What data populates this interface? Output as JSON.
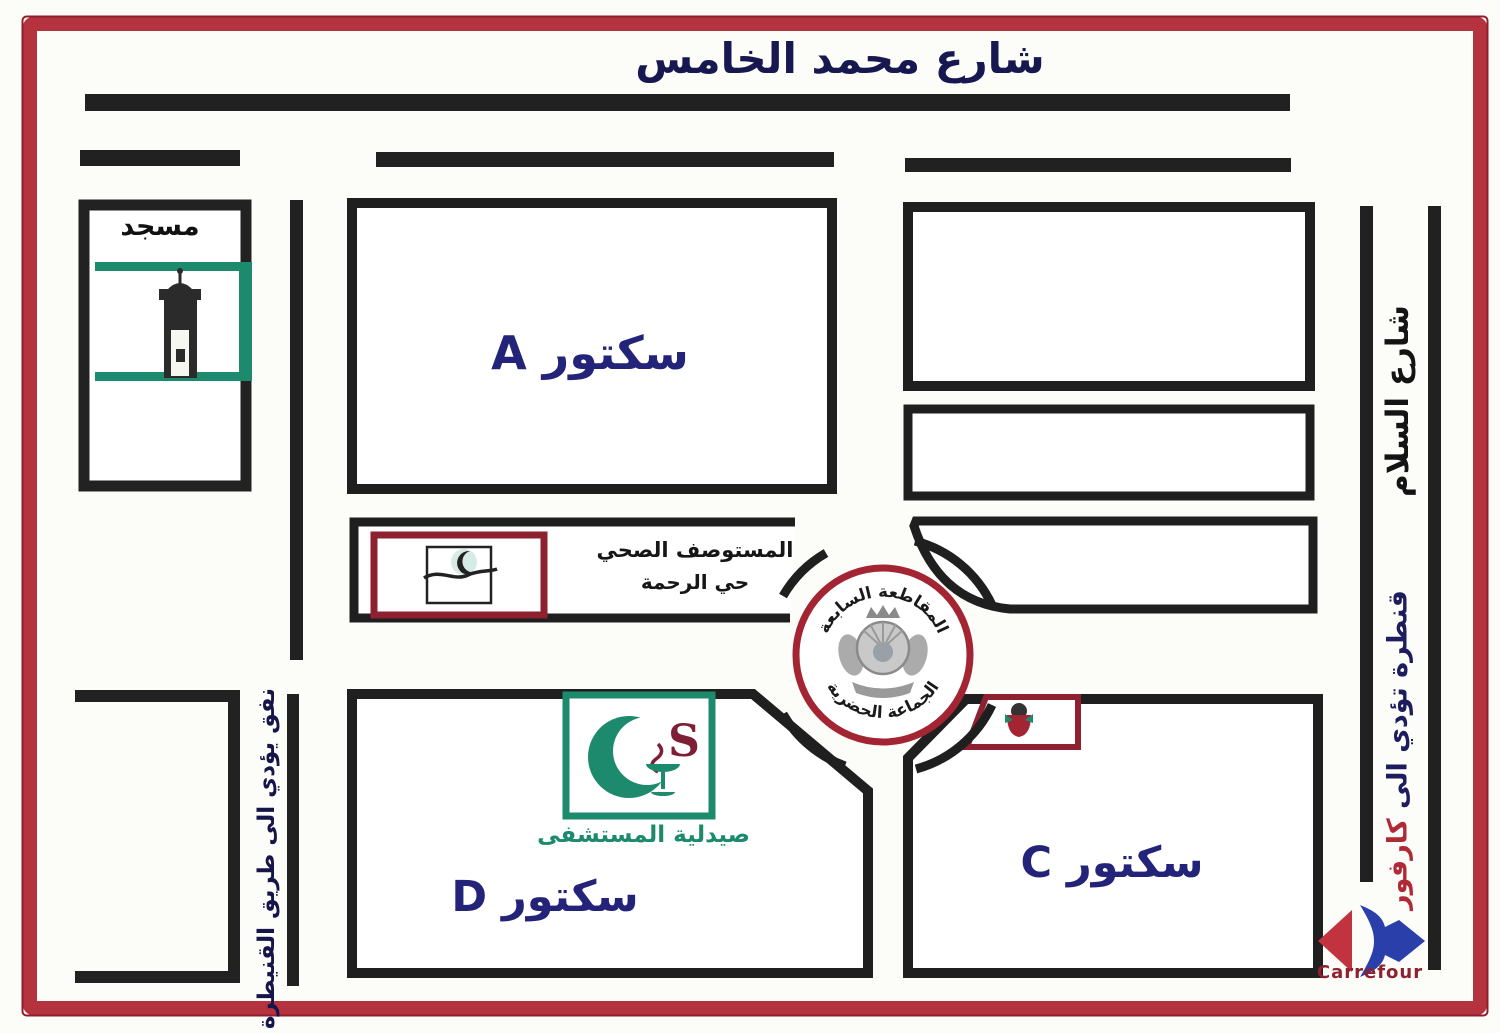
{
  "title": "شارع محمد الخامس",
  "right_street": {
    "name": "شارع السلام",
    "bridge_text": "قنطرة تؤدي الى ",
    "bridge_destination": "كارفور"
  },
  "left_street": {
    "tunnel_text": "نفق يؤدي الى طريق القنيطرة"
  },
  "mosque": {
    "label": "مسجد"
  },
  "sectors": {
    "a": "سكتور A",
    "c": "سكتور C",
    "d": "سكتور D"
  },
  "roundabout": {
    "top_text": "المقاطعة السابعة",
    "bottom_text": "الجماعة الحضرية"
  },
  "health_center": {
    "line1": "المستوصف الصحي",
    "line2": "حي الرحمة"
  },
  "pharmacy": {
    "label": "صيدلية المستشفى",
    "logo_letter": "S"
  },
  "carrefour": {
    "brand": "Carrefour"
  },
  "colors": {
    "frame_red": "#b5323f",
    "road_black": "#1f1f1f",
    "navy": "#23237a",
    "maroon": "#8e2130",
    "teal": "#1d8a6d",
    "stamp_red": "#a32433",
    "carrefour_blue": "#2b3faa",
    "carrefour_red": "#c23340"
  }
}
